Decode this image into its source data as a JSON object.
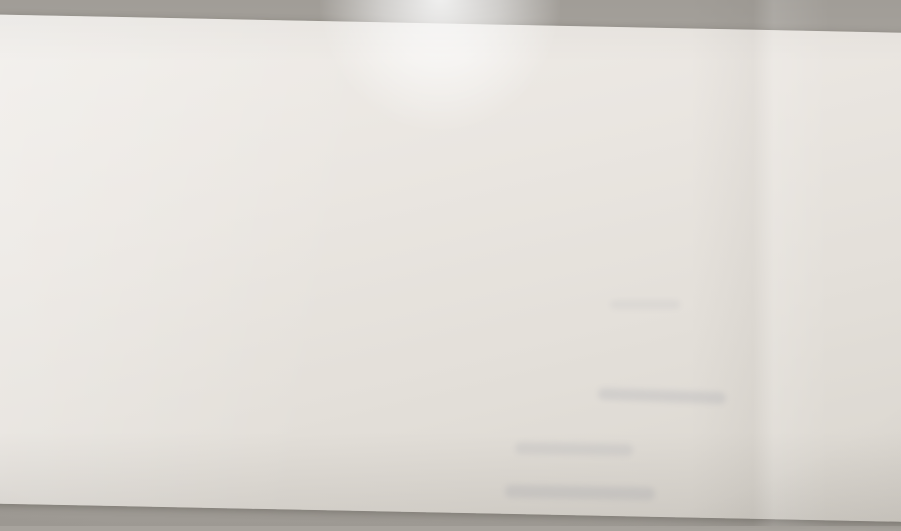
{
  "floorplan": {
    "total_area": "64,50",
    "rooms": [
      {
        "name": "bedroom",
        "area": "15,86"
      },
      {
        "name": "wc",
        "area": "1,55"
      },
      {
        "name": "bathroom",
        "area": "3,60"
      },
      {
        "name": "nursery",
        "area": "16,41"
      },
      {
        "name": "hallway",
        "area": "7,75"
      },
      {
        "name": "living-kitchen",
        "area": "18,13"
      },
      {
        "name": "balcony",
        "area": "4,00"
      }
    ],
    "colors": {
      "paper": "#eae6e1",
      "background": "#a7a39d",
      "wall": "#9a948b",
      "floor": "#f2efe9",
      "furniture_line": "#a7a198",
      "dark_accent": "#45413b",
      "label_text": "#57534c"
    }
  }
}
